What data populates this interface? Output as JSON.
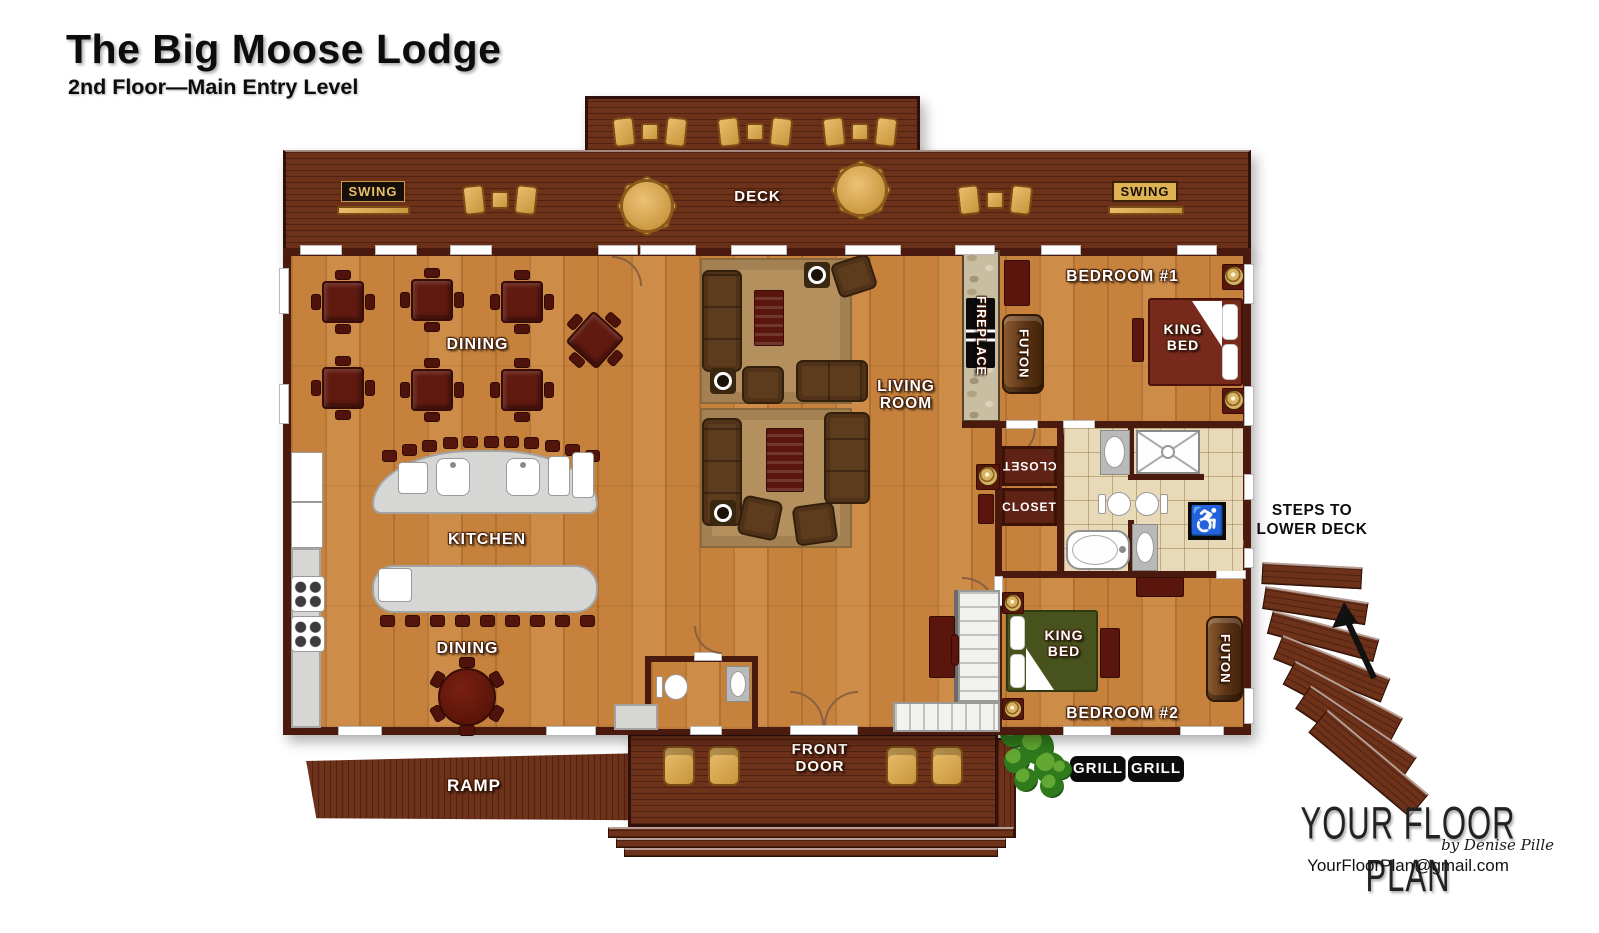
{
  "title": {
    "main": "The Big Moose Lodge",
    "subtitle": "2nd Floor—Main Entry Level"
  },
  "rooms": {
    "deck": "DECK",
    "dining_upper": "DINING",
    "kitchen": "KITCHEN",
    "dining_lower": "DINING",
    "living_room": "LIVING ROOM",
    "bedroom1": "BEDROOM #1",
    "bedroom2": "BEDROOM #2"
  },
  "features": {
    "swing_left": "SWING",
    "swing_right": "SWING",
    "fireplace": "FIREPLACE",
    "futon_bedroom1": "FUTON",
    "futon_bedroom2": "FUTON",
    "king_bed_bedroom1": "KING BED",
    "king_bed_bedroom2": "KING BED",
    "closet_upper": "CLOSET",
    "closet_lower": "CLOSET",
    "steps_note": "STEPS TO LOWER DECK",
    "front_door": "FRONT DOOR",
    "ramp": "RAMP",
    "grill_left": "GRILL",
    "grill_right": "GRILL"
  },
  "icons": {
    "accessible": "♿"
  },
  "branding": {
    "studio": "YOUR FLOOR PLAN",
    "byline": "by Denise Pille",
    "email": "YourFloorPlan@gmail.com"
  },
  "colors": {
    "deck_wood": "#6e3119",
    "floor_wood": "#c6823c",
    "wall": "#4a1a0e",
    "furniture_red": "#611a10",
    "bed1_spread": "#772a1c",
    "bed2_spread": "#47521d",
    "counter_gray": "#d6d6d4",
    "tile": "#e8dab8",
    "accent_tan": "#d9a74e",
    "label_white": "#ffffff"
  }
}
